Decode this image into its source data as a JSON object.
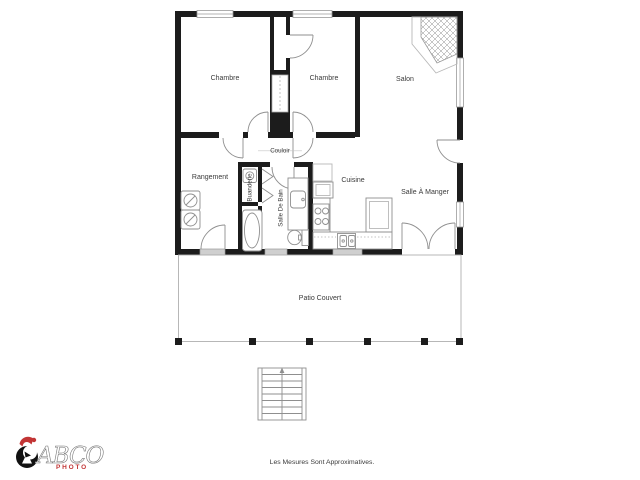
{
  "floor_plan": {
    "rooms": [
      {
        "name": "chambre-1",
        "label": "Chambre"
      },
      {
        "name": "chambre-2",
        "label": "Chambre"
      },
      {
        "name": "salon",
        "label": "Salon"
      },
      {
        "name": "couloir",
        "label": "Couloir"
      },
      {
        "name": "rangement",
        "label": "Rangement"
      },
      {
        "name": "buanderie",
        "label": "Buanderie"
      },
      {
        "name": "salle-de-bain",
        "label": "Salle De Bain"
      },
      {
        "name": "cuisine",
        "label": "Cuisine"
      },
      {
        "name": "salle-a-manger",
        "label": "Salle À Manger"
      },
      {
        "name": "patio-couvert",
        "label": "Patio Couvert"
      }
    ],
    "fixtures": [
      "fireplace",
      "stairs",
      "washer",
      "dryer",
      "bathtub",
      "toilet",
      "vanity-sink",
      "stove",
      "double-sink",
      "fridge",
      "sliding-closet",
      "bifold-doors",
      "patio-posts"
    ]
  },
  "branding": {
    "logo_text": "ABCO",
    "logo_subtext": "PHOTO"
  },
  "footer": {
    "disclaimer": "Les Mesures Sont Approximatives."
  },
  "colors": {
    "wall": "#1c1c1c",
    "thin_line": "#8f8f8f",
    "label_text": "#3a3a3a",
    "logo_red": "#c23535",
    "window_fill": "#cfcfcf"
  }
}
